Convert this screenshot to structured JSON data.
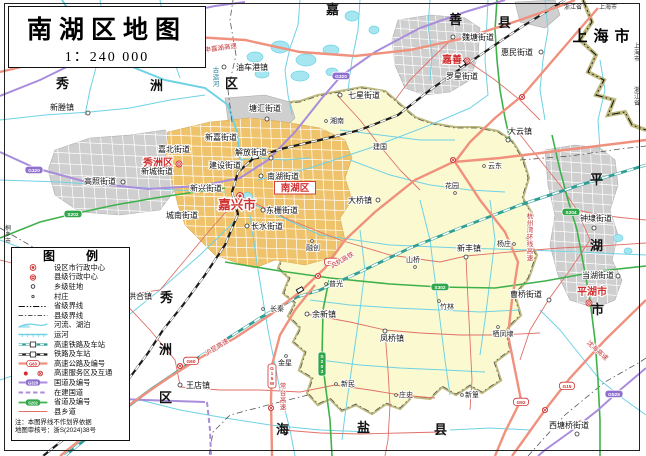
{
  "title": {
    "text": "南湖区地图",
    "scale": "1：240 000"
  },
  "legend": {
    "title": "图 例",
    "items": [
      {
        "sym": "city",
        "label": "设区市行政中心"
      },
      {
        "sym": "county",
        "label": "县级行政中心"
      },
      {
        "sym": "town",
        "label": "乡级驻地"
      },
      {
        "sym": "village",
        "label": "村庄"
      },
      {
        "sym": "provb",
        "label": "省级界线"
      },
      {
        "sym": "cntyb",
        "label": "县级界线"
      },
      {
        "sym": "river",
        "label": "河流、湖泊"
      },
      {
        "sym": "canal",
        "label": "运河"
      },
      {
        "sym": "hsr",
        "label": "高速铁路及车站"
      },
      {
        "sym": "rail",
        "label": "铁路及车站"
      },
      {
        "sym": "expwy",
        "label": "高速公路及编号",
        "badge": "G60"
      },
      {
        "sym": "svc",
        "label": "高速服务区及互通"
      },
      {
        "sym": "natl",
        "label": "国道及编号",
        "badge": "G320"
      },
      {
        "sym": "natlc",
        "label": "在建国道"
      },
      {
        "sym": "prov",
        "label": "省道及编号",
        "badge": "S202"
      },
      {
        "sym": "cntyrd",
        "label": "县乡道"
      }
    ],
    "note1": "注：本图界线不作划界依据",
    "note2": "地图审核号：浙S(2024)38号"
  },
  "colors": {
    "expressway": "#F0917E",
    "national_road": "#A98CDC",
    "provincial_road": "#3FB14B",
    "county_road": "#E07068",
    "railway": "#1B1B1B",
    "hsr": "#2E9E96",
    "water": "#6FD2E4",
    "water_fill": "#A5E6F0",
    "district_fill": "#FBF9D0",
    "district_border": "#A8A254",
    "urban_gray": "#CFCFCF",
    "urban_orange": "#EFC36C",
    "admin_red": "#D03030"
  },
  "map": {
    "labels": [
      {
        "t": "嘉兴市",
        "x": 237,
        "y": 209,
        "cls": "cap"
      },
      {
        "t": "秀洲区",
        "x": 158,
        "y": 166,
        "cls": "cnty"
      },
      {
        "t": "南湖区",
        "x": 295,
        "y": 191,
        "cls": "cnty-box"
      },
      {
        "t": "嘉善",
        "x": 452,
        "y": 63,
        "cls": "cnty"
      },
      {
        "t": "平湖市",
        "x": 592,
        "y": 295,
        "cls": "cnty"
      },
      {
        "t": "秀",
        "x": 63,
        "y": 88,
        "cls": "rg"
      },
      {
        "t": "洲",
        "x": 157,
        "y": 90,
        "cls": "rg"
      },
      {
        "t": "区",
        "x": 232,
        "y": 88,
        "cls": "rg"
      },
      {
        "t": "嘉",
        "x": 333,
        "y": 14,
        "cls": "rg"
      },
      {
        "t": "善",
        "x": 456,
        "y": 24,
        "cls": "rg"
      },
      {
        "t": "县",
        "x": 505,
        "y": 27,
        "cls": "rg"
      },
      {
        "t": "秀",
        "x": 167,
        "y": 302,
        "cls": "rg"
      },
      {
        "t": "洲",
        "x": 166,
        "y": 354,
        "cls": "rg"
      },
      {
        "t": "区",
        "x": 166,
        "y": 402,
        "cls": "rg"
      },
      {
        "t": "海",
        "x": 283,
        "y": 434,
        "cls": "rg"
      },
      {
        "t": "盐",
        "x": 364,
        "y": 432,
        "cls": "rg"
      },
      {
        "t": "县",
        "x": 441,
        "y": 434,
        "cls": "rg"
      },
      {
        "t": "平",
        "x": 597,
        "y": 184,
        "cls": "rg"
      },
      {
        "t": "湖",
        "x": 597,
        "y": 250,
        "cls": "rg"
      },
      {
        "t": "市",
        "x": 598,
        "y": 314,
        "cls": "rg"
      },
      {
        "t": "上海市",
        "x": 604,
        "y": 41,
        "cls": "rgb"
      },
      {
        "t": "桐乡市",
        "x": 8,
        "y": 230,
        "cls": "tiny",
        "vert": 1
      },
      {
        "t": "浙江省",
        "x": 573,
        "y": 9,
        "cls": "tiny"
      },
      {
        "t": "上海市",
        "x": 608,
        "y": 9,
        "cls": "tiny"
      },
      {
        "t": "上海市",
        "x": 637,
        "y": 48,
        "cls": "tiny",
        "vert": 1
      },
      {
        "t": "浙江省",
        "x": 637,
        "y": 92,
        "cls": "tiny",
        "vert": 1
      },
      {
        "t": "新塍镇",
        "x": 62,
        "y": 110,
        "cls": "tn"
      },
      {
        "t": "油车港镇",
        "x": 252,
        "y": 70,
        "cls": "tn"
      },
      {
        "t": "塘汇街道",
        "x": 265,
        "y": 111,
        "cls": "tn"
      },
      {
        "t": "七星街道",
        "x": 364,
        "y": 98,
        "cls": "tn"
      },
      {
        "t": "魏塘街道",
        "x": 478,
        "y": 40,
        "cls": "tn"
      },
      {
        "t": "惠民街道",
        "x": 517,
        "y": 55,
        "cls": "tn"
      },
      {
        "t": "罗星街道",
        "x": 462,
        "y": 79,
        "cls": "tn"
      },
      {
        "t": "大云镇",
        "x": 520,
        "y": 134,
        "cls": "tn"
      },
      {
        "t": "嘉北街道",
        "x": 174,
        "y": 152,
        "cls": "tn"
      },
      {
        "t": "新城街道",
        "x": 157,
        "y": 174,
        "cls": "tn"
      },
      {
        "t": "新嘉街道",
        "x": 221,
        "y": 140,
        "cls": "tn"
      },
      {
        "t": "解放街道",
        "x": 251,
        "y": 155,
        "cls": "tn"
      },
      {
        "t": "建设街道",
        "x": 225,
        "y": 168,
        "cls": "tn"
      },
      {
        "t": "南湖街道",
        "x": 283,
        "y": 179,
        "cls": "tn"
      },
      {
        "t": "新兴街道",
        "x": 206,
        "y": 191,
        "cls": "tn"
      },
      {
        "t": "城南街道",
        "x": 182,
        "y": 218,
        "cls": "tn"
      },
      {
        "t": "东栅街道",
        "x": 282,
        "y": 213,
        "cls": "tn"
      },
      {
        "t": "长水街道",
        "x": 267,
        "y": 229,
        "cls": "tn"
      },
      {
        "t": "大桥镇",
        "x": 360,
        "y": 203,
        "cls": "tn"
      },
      {
        "t": "新丰镇",
        "x": 469,
        "y": 251,
        "cls": "tn"
      },
      {
        "t": "凤桥镇",
        "x": 392,
        "y": 341,
        "cls": "tn"
      },
      {
        "t": "余新镇",
        "x": 324,
        "y": 317,
        "cls": "tn"
      },
      {
        "t": "王店镇",
        "x": 198,
        "y": 388,
        "cls": "tn"
      },
      {
        "t": "洪合镇",
        "x": 140,
        "y": 299,
        "cls": "tn"
      },
      {
        "t": "高照街道",
        "x": 100,
        "y": 184,
        "cls": "tn"
      },
      {
        "t": "曹桥街道",
        "x": 526,
        "y": 297,
        "cls": "tn"
      },
      {
        "t": "钟埭街道",
        "x": 596,
        "y": 221,
        "cls": "tn"
      },
      {
        "t": "当湖街道",
        "x": 598,
        "y": 278,
        "cls": "tn"
      },
      {
        "t": "西塘桥街道",
        "x": 569,
        "y": 428,
        "cls": "tn"
      },
      {
        "t": "湘南",
        "x": 337,
        "y": 123,
        "cls": "vl"
      },
      {
        "t": "建国",
        "x": 380,
        "y": 149,
        "cls": "vl"
      },
      {
        "t": "云东",
        "x": 495,
        "y": 168,
        "cls": "vl"
      },
      {
        "t": "花园",
        "x": 452,
        "y": 188,
        "cls": "vl"
      },
      {
        "t": "杨庄",
        "x": 504,
        "y": 246,
        "cls": "vl"
      },
      {
        "t": "山桥",
        "x": 413,
        "y": 262,
        "cls": "vl"
      },
      {
        "t": "竹林",
        "x": 447,
        "y": 309,
        "cls": "vl"
      },
      {
        "t": "栖凤埭",
        "x": 503,
        "y": 336,
        "cls": "vl"
      },
      {
        "t": "长秦",
        "x": 277,
        "y": 311,
        "cls": "vl"
      },
      {
        "t": "金星",
        "x": 285,
        "y": 365,
        "cls": "vl"
      },
      {
        "t": "新民",
        "x": 348,
        "y": 386,
        "cls": "vl"
      },
      {
        "t": "庄史",
        "x": 406,
        "y": 397,
        "cls": "vl"
      },
      {
        "t": "新篁",
        "x": 472,
        "y": 397,
        "cls": "vl"
      },
      {
        "t": "普光",
        "x": 336,
        "y": 286,
        "cls": "vl"
      },
      {
        "t": "融创",
        "x": 313,
        "y": 250,
        "cls": "vl"
      },
      {
        "t": "申嘉湖高速",
        "x": 221,
        "y": 50,
        "cls": "rd",
        "rot": -8
      },
      {
        "t": "沪昆高速",
        "x": 218,
        "y": 349,
        "cls": "rd",
        "rot": -32
      },
      {
        "t": "常台高速",
        "x": 283,
        "y": 388,
        "cls": "rd",
        "vert": 1
      },
      {
        "t": "沪杭高铁",
        "x": 343,
        "y": 262,
        "cls": "rd",
        "rot": -30
      },
      {
        "t": "杭州湾环线高速",
        "x": 530,
        "y": 218,
        "cls": "rd",
        "vert": 1
      },
      {
        "t": "沈海高速",
        "x": 596,
        "y": 352,
        "cls": "rd",
        "rot": 42
      },
      {
        "t": "古运河",
        "x": 216,
        "y": 72,
        "cls": "wt",
        "vert": 1
      }
    ],
    "badges": [
      {
        "t": "S12",
        "x": 193,
        "y": 38,
        "kind": "exp"
      },
      {
        "t": "G60",
        "x": 332,
        "y": 262,
        "kind": "exp"
      },
      {
        "t": "G60",
        "x": 191,
        "y": 361,
        "kind": "exp"
      },
      {
        "t": "G15W",
        "x": 272,
        "y": 368,
        "kind": "exp",
        "vert": 1
      },
      {
        "t": "G92",
        "x": 521,
        "y": 402,
        "kind": "exp"
      },
      {
        "t": "G15",
        "x": 567,
        "y": 386,
        "kind": "exp"
      },
      {
        "t": "G524",
        "x": 177,
        "y": 16,
        "kind": "natl",
        "vert": 1
      },
      {
        "t": "G320",
        "x": 341,
        "y": 76,
        "kind": "natl"
      },
      {
        "t": "G320",
        "x": 34,
        "y": 170,
        "kind": "natl"
      },
      {
        "t": "G525",
        "x": 614,
        "y": 394,
        "kind": "natl"
      },
      {
        "t": "S202",
        "x": 73,
        "y": 214,
        "kind": "prov"
      },
      {
        "t": "S302",
        "x": 440,
        "y": 287,
        "kind": "prov"
      },
      {
        "t": "S203",
        "x": 322,
        "y": 356,
        "kind": "prov",
        "vert": 1
      },
      {
        "t": "S204",
        "x": 571,
        "y": 212,
        "kind": "prov"
      }
    ],
    "symbols": [
      {
        "k": "city",
        "x": 240,
        "y": 196
      },
      {
        "k": "county",
        "x": 179,
        "y": 164
      },
      {
        "k": "county",
        "x": 467,
        "y": 61
      },
      {
        "k": "county",
        "x": 589,
        "y": 303
      },
      {
        "k": "town",
        "x": 88,
        "y": 113
      },
      {
        "k": "town",
        "x": 224,
        "y": 67
      },
      {
        "k": "town",
        "x": 267,
        "y": 119
      },
      {
        "k": "town",
        "x": 340,
        "y": 95
      },
      {
        "k": "town",
        "x": 453,
        "y": 37
      },
      {
        "k": "town",
        "x": 541,
        "y": 52
      },
      {
        "k": "town",
        "x": 508,
        "y": 140
      },
      {
        "k": "town",
        "x": 271,
        "y": 158
      },
      {
        "k": "town",
        "x": 261,
        "y": 176
      },
      {
        "k": "town",
        "x": 263,
        "y": 210
      },
      {
        "k": "town",
        "x": 247,
        "y": 226
      },
      {
        "k": "town",
        "x": 378,
        "y": 200
      },
      {
        "k": "town",
        "x": 466,
        "y": 257
      },
      {
        "k": "town",
        "x": 385,
        "y": 331
      },
      {
        "k": "town",
        "x": 307,
        "y": 314
      },
      {
        "k": "town",
        "x": 180,
        "y": 385
      },
      {
        "k": "town",
        "x": 121,
        "y": 296
      },
      {
        "k": "town",
        "x": 123,
        "y": 182
      },
      {
        "k": "town",
        "x": 549,
        "y": 300
      },
      {
        "k": "town",
        "x": 594,
        "y": 228
      },
      {
        "k": "town",
        "x": 618,
        "y": 276
      },
      {
        "k": "town",
        "x": 577,
        "y": 434
      },
      {
        "k": "village",
        "x": 484,
        "y": 166
      },
      {
        "k": "village",
        "x": 455,
        "y": 193
      },
      {
        "k": "village",
        "x": 514,
        "y": 244
      },
      {
        "k": "village",
        "x": 415,
        "y": 267
      },
      {
        "k": "village",
        "x": 439,
        "y": 301
      },
      {
        "k": "village",
        "x": 498,
        "y": 327
      },
      {
        "k": "village",
        "x": 263,
        "y": 309
      },
      {
        "k": "village",
        "x": 286,
        "y": 356
      },
      {
        "k": "village",
        "x": 336,
        "y": 384
      },
      {
        "k": "village",
        "x": 396,
        "y": 395
      },
      {
        "k": "village",
        "x": 462,
        "y": 395
      },
      {
        "k": "village",
        "x": 326,
        "y": 284
      },
      {
        "k": "village",
        "x": 312,
        "y": 241
      },
      {
        "k": "village",
        "x": 326,
        "y": 121
      },
      {
        "k": "interchange",
        "x": 453,
        "y": 160
      },
      {
        "k": "interchange",
        "x": 318,
        "y": 276
      },
      {
        "k": "interchange",
        "x": 271,
        "y": 408
      },
      {
        "k": "interchange",
        "x": 180,
        "y": 366
      },
      {
        "k": "interchange",
        "x": 522,
        "y": 97
      },
      {
        "k": "interchange",
        "x": 545,
        "y": 410
      },
      {
        "k": "service",
        "x": 580,
        "y": 422
      },
      {
        "k": "station",
        "x": 255,
        "y": 157,
        "rot": -8
      },
      {
        "k": "station",
        "x": 462,
        "y": 64,
        "rot": -38
      },
      {
        "k": "station",
        "x": 300,
        "y": 290,
        "rot": -30
      }
    ]
  }
}
